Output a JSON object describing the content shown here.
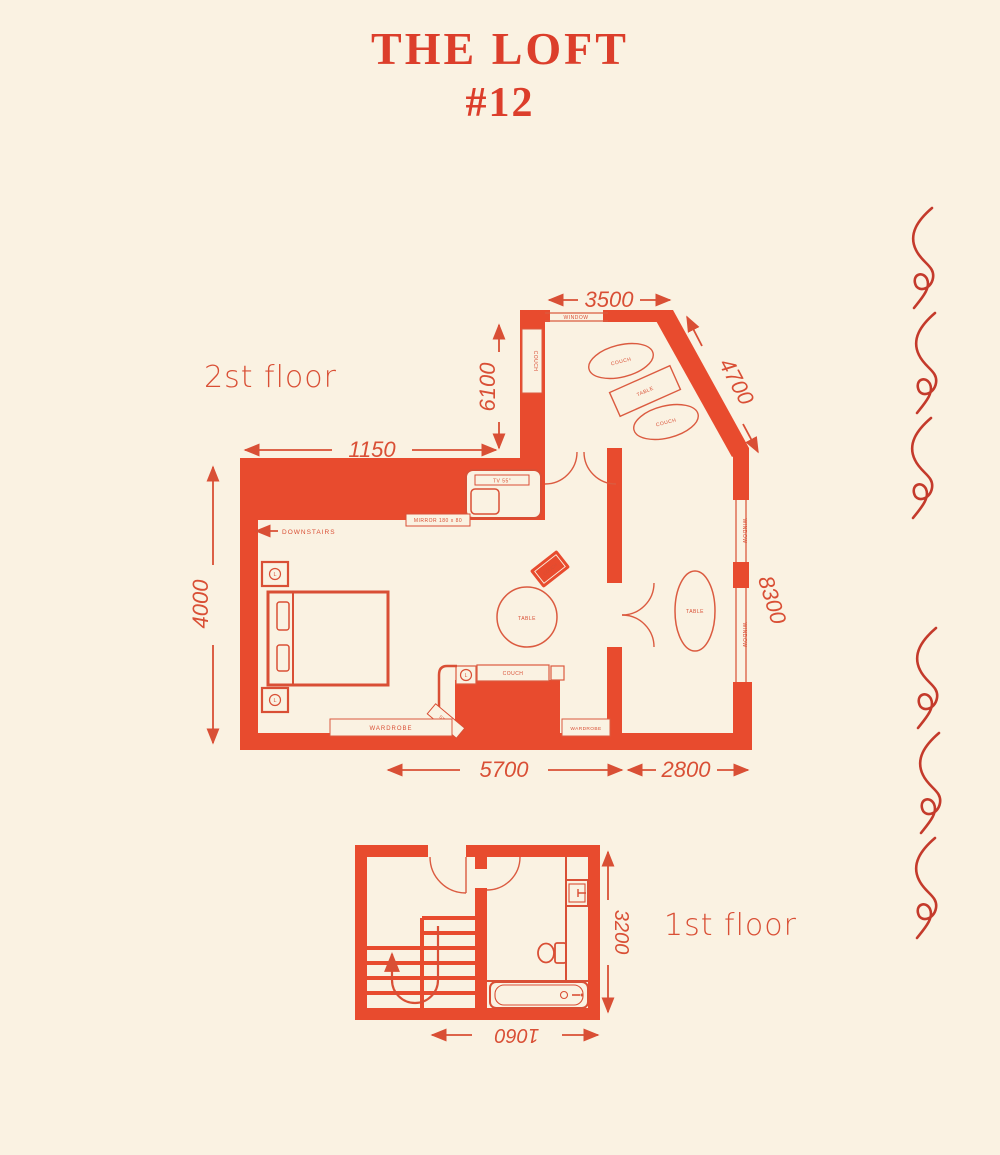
{
  "colors": {
    "background": "#FAF2E2",
    "wall": "#E84B2E",
    "accent": "#D94F35",
    "furniture_line": "#DB5B40",
    "decor_wave": "#C43A2B"
  },
  "title": {
    "line1": "THE LOFT",
    "line2": "#12"
  },
  "floor2": {
    "label": "2st floor",
    "dims": {
      "top": "3500",
      "diagonal": "4700",
      "entry": "6100",
      "hall": "1150",
      "left": "4000",
      "right": "8300",
      "bottom_left": "5700",
      "bottom_right": "2800"
    },
    "labels": {
      "window": "WINDOW",
      "couch": "COUCH",
      "table": "TABLE",
      "tv": "TV 55\"",
      "mirror": "MIRROR 180 x 80",
      "downstairs": "DOWNSTAIRS",
      "wardrobe": "WARDROBE",
      "lamp": "L",
      "stairs": "STAIRS"
    }
  },
  "floor1": {
    "label": "1st floor",
    "dims": {
      "height": "3200",
      "bath_width": "1060"
    }
  }
}
